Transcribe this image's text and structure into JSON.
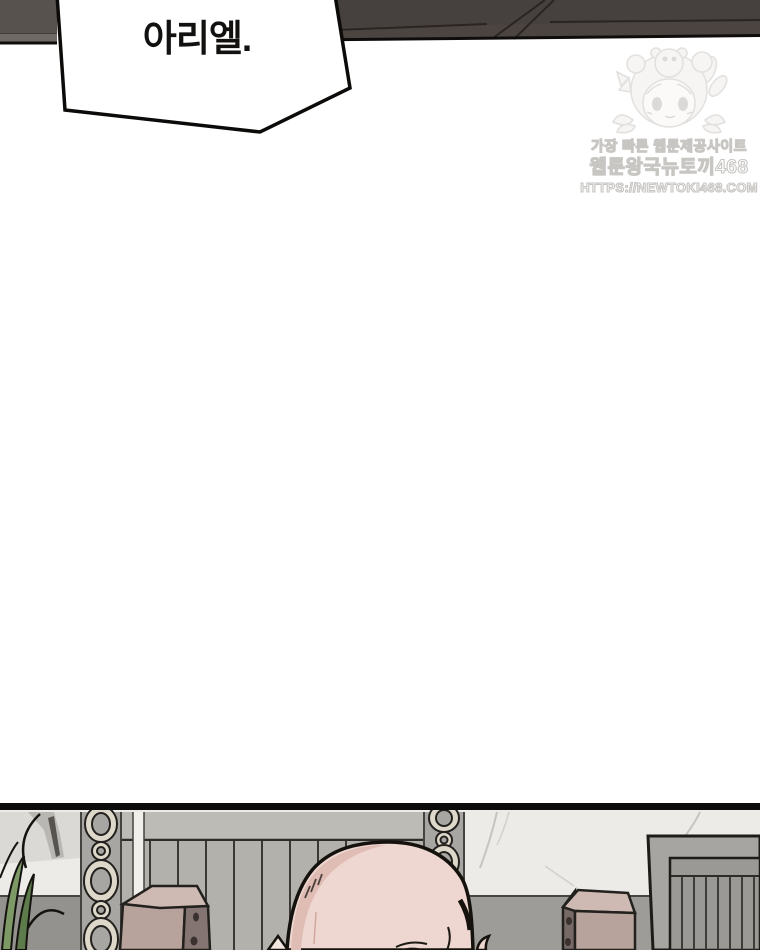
{
  "page": {
    "type": "webtoon-comic-page"
  },
  "speech_bubble": {
    "text": "아리엘."
  },
  "watermark": {
    "line1": "가장 빠른 웹툰제공사이트",
    "line2": "웹툰왕국뉴토끼468",
    "line3": "HTTPS://NEWTOKI468.COM"
  },
  "colors": {
    "beam_dark": "#4b4441",
    "skin": "#eed7d0",
    "skin_shadow": "#dfbcb4",
    "fence_gray": "#b3b1ac",
    "marble": "#edebe7",
    "chain_link": "#ddd8c9",
    "stone_block_top": "#cfbab3",
    "stone_block_front": "#b7a29c",
    "plant_green": "#7d9a66",
    "watermark_text": "#ffffff",
    "watermark_outline": "#c8c6c3"
  }
}
